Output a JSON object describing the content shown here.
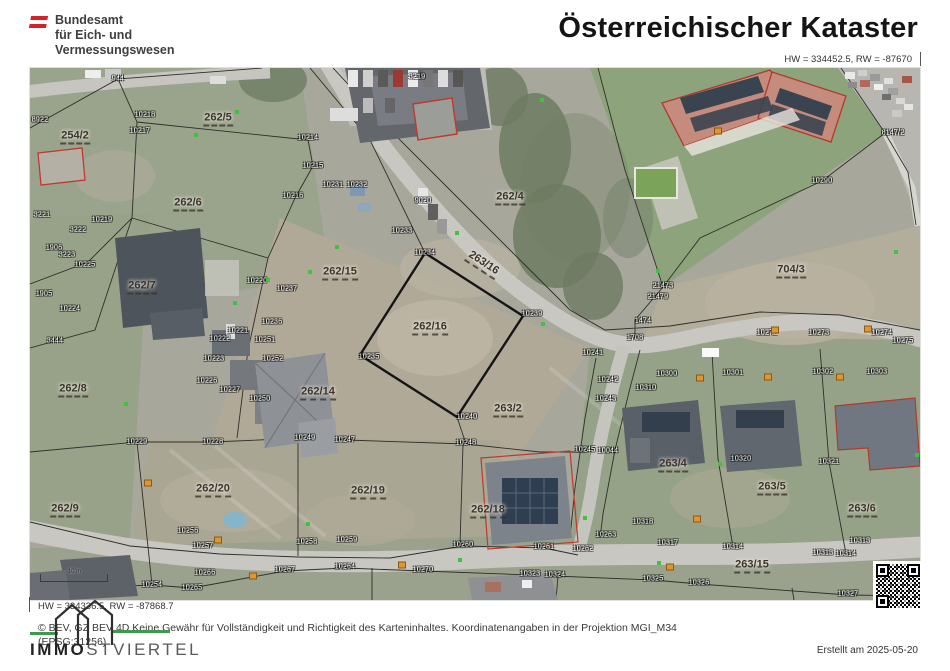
{
  "header": {
    "agency_line1": "Bundesamt",
    "agency_line2": "für Eich- und",
    "agency_line3": "Vermessungswesen",
    "title": "Österreichischer Kataster",
    "coord_top_right": "HW = 334452.5, RW = -87670"
  },
  "map": {
    "scale_label": "10 m",
    "coord_bottom_left": "HW = 334336.5, RW = -87868.7",
    "parcel_labels": [
      {
        "t": "254/2",
        "x": 45,
        "y": 69
      },
      {
        "t": "262/5",
        "x": 188,
        "y": 51
      },
      {
        "t": "262/6",
        "x": 158,
        "y": 136
      },
      {
        "t": "262/7",
        "x": 112,
        "y": 219
      },
      {
        "t": "262/8",
        "x": 43,
        "y": 322
      },
      {
        "t": "262/9",
        "x": 35,
        "y": 442
      },
      {
        "t": "262/15",
        "x": 310,
        "y": 205
      },
      {
        "t": "262/16",
        "x": 400,
        "y": 260
      },
      {
        "t": "262/14",
        "x": 288,
        "y": 325
      },
      {
        "t": "262/4",
        "x": 480,
        "y": 130
      },
      {
        "t": "263/16",
        "x": 453,
        "y": 196,
        "rot": 33
      },
      {
        "t": "704/3",
        "x": 761,
        "y": 203
      },
      {
        "t": "263/2",
        "x": 478,
        "y": 342
      },
      {
        "t": "262/20",
        "x": 183,
        "y": 422
      },
      {
        "t": "262/19",
        "x": 338,
        "y": 424
      },
      {
        "t": "262/18",
        "x": 458,
        "y": 443
      },
      {
        "t": "263/4",
        "x": 643,
        "y": 397
      },
      {
        "t": "263/5",
        "x": 742,
        "y": 420
      },
      {
        "t": "263/6",
        "x": 832,
        "y": 442
      },
      {
        "t": "263/15",
        "x": 722,
        "y": 498
      }
    ],
    "point_labels": [
      {
        "t": "944",
        "x": 88,
        "y": 11
      },
      {
        "t": "3219",
        "x": 387,
        "y": 9
      },
      {
        "t": "10218",
        "x": 115,
        "y": 47
      },
      {
        "t": "10217",
        "x": 110,
        "y": 63
      },
      {
        "t": "8922",
        "x": 10,
        "y": 52
      },
      {
        "t": "10214",
        "x": 278,
        "y": 70
      },
      {
        "t": "10215",
        "x": 283,
        "y": 98
      },
      {
        "t": "10216",
        "x": 263,
        "y": 128
      },
      {
        "t": "10231",
        "x": 303,
        "y": 117
      },
      {
        "t": "10232",
        "x": 327,
        "y": 117
      },
      {
        "t": "9020",
        "x": 393,
        "y": 133
      },
      {
        "t": "10233",
        "x": 372,
        "y": 163
      },
      {
        "t": "10234",
        "x": 395,
        "y": 185
      },
      {
        "t": "8147/2",
        "x": 863,
        "y": 65
      },
      {
        "t": "10290",
        "x": 792,
        "y": 113
      },
      {
        "t": "21473",
        "x": 633,
        "y": 218
      },
      {
        "t": "21479",
        "x": 628,
        "y": 229
      },
      {
        "t": "3221",
        "x": 12,
        "y": 147
      },
      {
        "t": "3222",
        "x": 48,
        "y": 162
      },
      {
        "t": "1906",
        "x": 24,
        "y": 180
      },
      {
        "t": "3223",
        "x": 37,
        "y": 187
      },
      {
        "t": "10219",
        "x": 72,
        "y": 152
      },
      {
        "t": "10225",
        "x": 55,
        "y": 197
      },
      {
        "t": "10237",
        "x": 257,
        "y": 221
      },
      {
        "t": "10220",
        "x": 227,
        "y": 213
      },
      {
        "t": "1905",
        "x": 14,
        "y": 226
      },
      {
        "t": "10224",
        "x": 40,
        "y": 241
      },
      {
        "t": "3444",
        "x": 25,
        "y": 273
      },
      {
        "t": "10221",
        "x": 208,
        "y": 263
      },
      {
        "t": "10222",
        "x": 190,
        "y": 271
      },
      {
        "t": "10236",
        "x": 242,
        "y": 254
      },
      {
        "t": "10251",
        "x": 235,
        "y": 272
      },
      {
        "t": "10223",
        "x": 184,
        "y": 291
      },
      {
        "t": "10252",
        "x": 243,
        "y": 291
      },
      {
        "t": "10226",
        "x": 177,
        "y": 313
      },
      {
        "t": "10227",
        "x": 200,
        "y": 322
      },
      {
        "t": "10250",
        "x": 230,
        "y": 331
      },
      {
        "t": "10235",
        "x": 339,
        "y": 289
      },
      {
        "t": "10239",
        "x": 502,
        "y": 246
      },
      {
        "t": "1474",
        "x": 613,
        "y": 253
      },
      {
        "t": "1708",
        "x": 605,
        "y": 270
      },
      {
        "t": "10241",
        "x": 563,
        "y": 285
      },
      {
        "t": "10242",
        "x": 578,
        "y": 312
      },
      {
        "t": "10243",
        "x": 576,
        "y": 331
      },
      {
        "t": "10272",
        "x": 737,
        "y": 265
      },
      {
        "t": "10273",
        "x": 789,
        "y": 265
      },
      {
        "t": "10274",
        "x": 852,
        "y": 265
      },
      {
        "t": "10275",
        "x": 873,
        "y": 273
      },
      {
        "t": "10300",
        "x": 637,
        "y": 306
      },
      {
        "t": "10301",
        "x": 703,
        "y": 305
      },
      {
        "t": "10302",
        "x": 793,
        "y": 304
      },
      {
        "t": "10303",
        "x": 847,
        "y": 304
      },
      {
        "t": "10310",
        "x": 616,
        "y": 320
      },
      {
        "t": "10240",
        "x": 437,
        "y": 349
      },
      {
        "t": "10229",
        "x": 107,
        "y": 374
      },
      {
        "t": "10228",
        "x": 183,
        "y": 374
      },
      {
        "t": "10249",
        "x": 275,
        "y": 370
      },
      {
        "t": "10247",
        "x": 315,
        "y": 372
      },
      {
        "t": "10248",
        "x": 436,
        "y": 375
      },
      {
        "t": "10245",
        "x": 555,
        "y": 382
      },
      {
        "t": "10044",
        "x": 578,
        "y": 383
      },
      {
        "t": "10320",
        "x": 711,
        "y": 391
      },
      {
        "t": "10321",
        "x": 799,
        "y": 394
      },
      {
        "t": "10318",
        "x": 613,
        "y": 454
      },
      {
        "t": "10317",
        "x": 638,
        "y": 475
      },
      {
        "t": "10314",
        "x": 703,
        "y": 479
      },
      {
        "t": "10313",
        "x": 830,
        "y": 473
      },
      {
        "t": "10313",
        "x": 793,
        "y": 485
      },
      {
        "t": "10314",
        "x": 816,
        "y": 486
      },
      {
        "t": "10263",
        "x": 576,
        "y": 467
      },
      {
        "t": "10262",
        "x": 553,
        "y": 481
      },
      {
        "t": "10261",
        "x": 514,
        "y": 479
      },
      {
        "t": "10256",
        "x": 158,
        "y": 463
      },
      {
        "t": "10257",
        "x": 173,
        "y": 478
      },
      {
        "t": "10258",
        "x": 277,
        "y": 474
      },
      {
        "t": "10259",
        "x": 317,
        "y": 472
      },
      {
        "t": "10260",
        "x": 433,
        "y": 477
      },
      {
        "t": "10254",
        "x": 122,
        "y": 517
      },
      {
        "t": "10266",
        "x": 175,
        "y": 505
      },
      {
        "t": "10265",
        "x": 162,
        "y": 520
      },
      {
        "t": "10267",
        "x": 255,
        "y": 502
      },
      {
        "t": "10264",
        "x": 315,
        "y": 499
      },
      {
        "t": "10270",
        "x": 393,
        "y": 502
      },
      {
        "t": "10323",
        "x": 500,
        "y": 506
      },
      {
        "t": "10324",
        "x": 525,
        "y": 507
      },
      {
        "t": "10325",
        "x": 623,
        "y": 511
      },
      {
        "t": "10326",
        "x": 669,
        "y": 515
      },
      {
        "t": "10327",
        "x": 818,
        "y": 526
      }
    ],
    "green_markers": [
      [
        207,
        44
      ],
      [
        307,
        179
      ],
      [
        427,
        165
      ],
      [
        513,
        256
      ],
      [
        628,
        203
      ],
      [
        866,
        184
      ],
      [
        205,
        235
      ],
      [
        280,
        204
      ],
      [
        430,
        492
      ],
      [
        629,
        495
      ],
      [
        278,
        456
      ],
      [
        96,
        336
      ],
      [
        166,
        67
      ],
      [
        512,
        32
      ],
      [
        887,
        387
      ],
      [
        690,
        396
      ],
      [
        555,
        450
      ],
      [
        238,
        212
      ]
    ],
    "orange_markers": [
      [
        688,
        63
      ],
      [
        667,
        451
      ],
      [
        188,
        472
      ],
      [
        223,
        508
      ],
      [
        372,
        497
      ],
      [
        640,
        499
      ],
      [
        745,
        262
      ],
      [
        838,
        261
      ],
      [
        670,
        310
      ],
      [
        738,
        309
      ],
      [
        810,
        309
      ],
      [
        118,
        415
      ]
    ]
  },
  "footer": {
    "copyright": "© BEV, GZ BEV 4D Keine Gewähr für Vollständigkeit und Richtigkeit des Karteninhaltes. Koordinatenangaben in der Projektion  MGI_M34",
    "epsg": "(EPSG:31256)",
    "brand_bold": "IMMO",
    "brand_rest": "STVIERTEL",
    "created": "Erstellt am 2025-05-20"
  },
  "colors": {
    "flag_red": "#d2232a",
    "parcel_outline_red": "#c0392b",
    "brand_green": "#3d9a4e",
    "map_label_brown": "#3c342a",
    "subject_parcel_outline": "#151515"
  }
}
